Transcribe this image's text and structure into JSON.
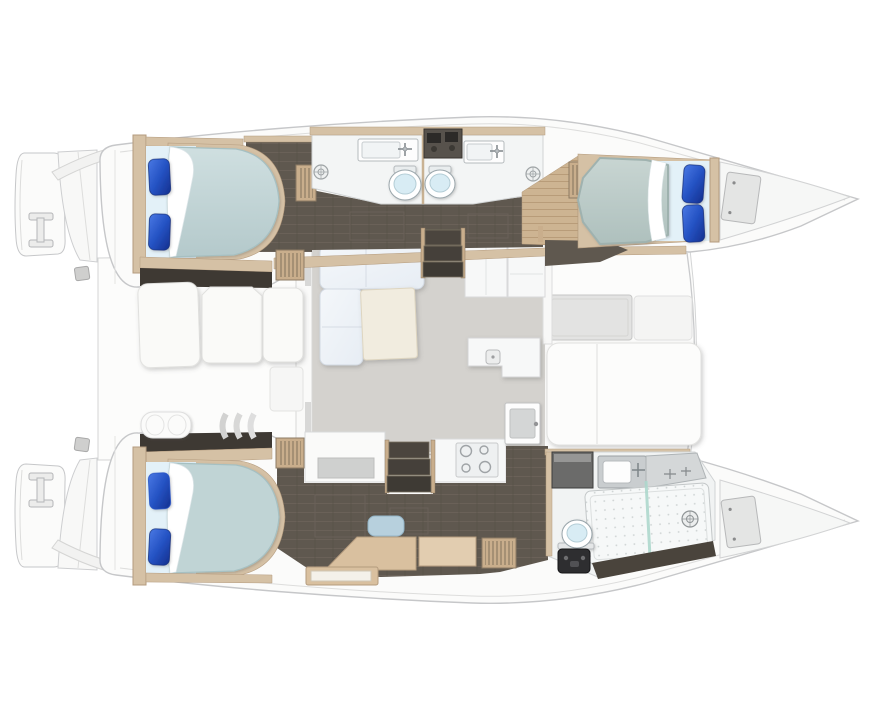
{
  "meta": {
    "image_type": "yacht floor plan illustration",
    "vessel_type": "catamaran",
    "view": "overhead top-down",
    "bow_direction": "right",
    "canvas": {
      "width": 870,
      "height": 720
    }
  },
  "palette": {
    "background": "#ffffff",
    "hull_white": "#fbfbfa",
    "deck_white": "#f7f7f6",
    "outline_gray": "#c6c7c9",
    "rim_gray": "#dddddc",
    "trim_wood": "#d5c1a5",
    "wood_dark": "#b49b7e",
    "wood_floor": "#cdb492",
    "louver_wood": "#c9ae8c",
    "floor_dark": "#5f584f",
    "bulkhead_dark": "#3e3933",
    "step_dark": "#4b453e",
    "mattress_teal": "#c0d4d5",
    "mattress_gray": "#bccac7",
    "sheet_blue": "#e3f1f8",
    "pillow_blue": "#2553c4",
    "fold_white": "#ffffff",
    "salon_floor": "#d4d2ce",
    "sofa_white": "#eef2f7",
    "table_cream": "#f1ecdf",
    "cushion_white": "#fafaf8",
    "counter_white": "#f7f8f8",
    "bath_floor": "#f3f5f5",
    "toilet_lid": "#d8ecf4",
    "glass_teal": "#aed8cd",
    "stool_blue": "#b7d0dd",
    "cabinet_gray": "#6b6b6a",
    "unit_black": "#2e2e30",
    "hatch_gray": "#e3e3e2",
    "window_gray": "#d8d8d7"
  },
  "counts": {
    "hulls": 2,
    "cabins": 3,
    "double_beds": 3,
    "pillows": 6,
    "toilets": 3,
    "bathroom_sinks": 3,
    "shower_drains": 3,
    "cooktop_burners": 4,
    "stern_platforms": 2,
    "bow_lockers": 2
  },
  "rooms": [
    {
      "id": "aft-cockpit",
      "label": "aft cockpit",
      "features": [
        "lounge cushions",
        "bench seat",
        "molded steps",
        "transom walkway"
      ]
    },
    {
      "id": "salon",
      "label": "salon and galley",
      "features": [
        "L-shaped sofa",
        "coffee table",
        "galley cabinets",
        "island with sink",
        "cooktop",
        "forward door"
      ]
    },
    {
      "id": "port-aft-cabin",
      "label": "port aft double cabin",
      "features": [
        "double bed",
        "two blue pillows",
        "louvered wardrobe"
      ]
    },
    {
      "id": "port-bathrooms",
      "label": "two port-hull bathrooms",
      "features": [
        "two sinks",
        "two toilets",
        "two shower drains",
        "central locker"
      ]
    },
    {
      "id": "port-forward-cabin",
      "label": "port forward double cabin",
      "features": [
        "double bed",
        "two blue pillows",
        "bow locker"
      ]
    },
    {
      "id": "starboard-aft-cabin",
      "label": "starboard aft double cabin (owner suite)",
      "features": [
        "double bed",
        "two blue pillows",
        "desk",
        "vanity stool",
        "shelving"
      ]
    },
    {
      "id": "starboard-bathroom",
      "label": "starboard forward bathroom",
      "features": [
        "sink",
        "toilet",
        "shower with glass partition",
        "shower drain",
        "bow locker"
      ]
    },
    {
      "id": "foredeck",
      "label": "foredeck",
      "features": [
        "deck hatch",
        "sunpad"
      ]
    },
    {
      "id": "stern-platforms",
      "label": "twin swim platforms",
      "features": [
        "boarding handles",
        "cleats"
      ]
    }
  ]
}
